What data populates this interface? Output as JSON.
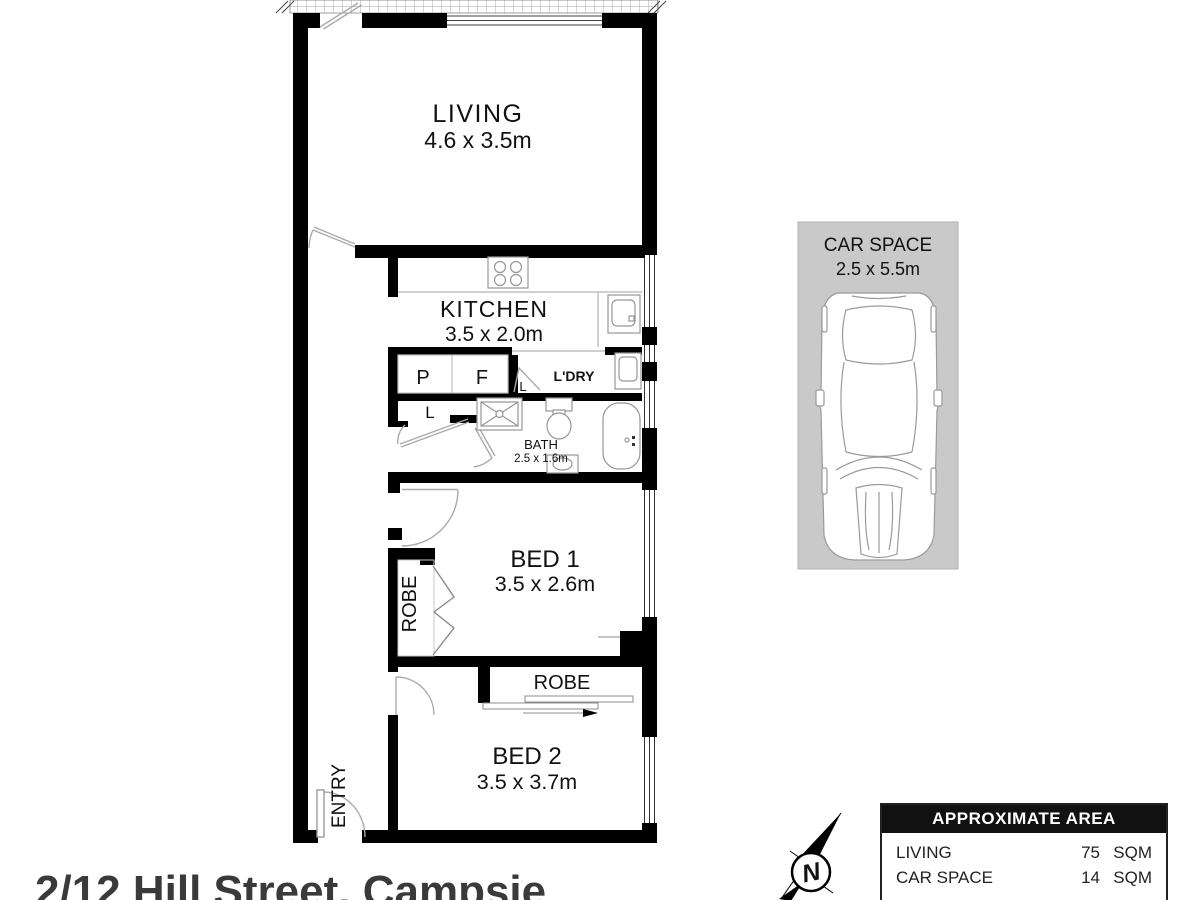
{
  "floorplan": {
    "living": {
      "label": "LIVING",
      "dims": "4.6 x 3.5m"
    },
    "kitchen": {
      "label": "KITCHEN",
      "dims": "3.5 x 2.0m"
    },
    "bath": {
      "label": "BATH",
      "dims": "2.5 x 1.6m"
    },
    "bed1": {
      "label": "BED 1",
      "dims": "3.5 x 2.6m"
    },
    "bed2": {
      "label": "BED 2",
      "dims": "3.5 x 3.7m"
    },
    "car_space": {
      "label": "CAR SPACE",
      "dims": "2.5 x 5.5m"
    },
    "pantry": "P",
    "fridge": "F",
    "laundry": "L'DRY",
    "linen_hall": "L",
    "linen_ldry": "L",
    "robe1": "ROBE",
    "robe2": "ROBE",
    "entry": "ENTRY",
    "compass_letter": "N"
  },
  "area_table": {
    "title": "APPROXIMATE AREA",
    "rows": [
      {
        "label": "LIVING",
        "value": "75",
        "unit": "SQM"
      },
      {
        "label": "CAR SPACE",
        "value": "14",
        "unit": "SQM"
      }
    ]
  },
  "address": "2/12 Hill Street, Campsie",
  "colors": {
    "wall": "#000000",
    "carspace_bg": "#c9c9c9",
    "fixture": "#969696",
    "door": "#aaaaaa"
  }
}
